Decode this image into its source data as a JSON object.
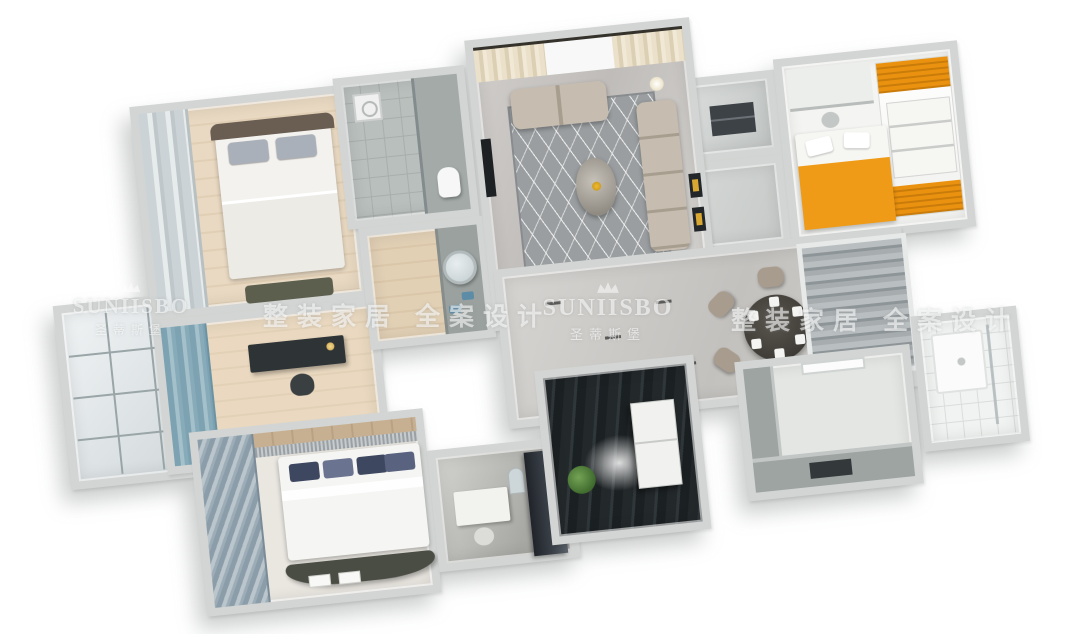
{
  "scene": {
    "type": "3D apartment floor plan render, dollhouse top view",
    "background": "#ffffff"
  },
  "watermark": {
    "brand_latin": "SUNIISBO",
    "brand_chinese": "圣蒂斯堡",
    "slogan": "整装家居 全案设计",
    "color": "rgba(255,255,255,0.58)"
  },
  "palette": {
    "wall_gray": "#d2d5d3",
    "marble_floor": "#c8c6c3",
    "wood_floor": "#e6d6bf",
    "dark_plank_floor": "#23282a",
    "accent_orange": "#ef9b17",
    "accent_blue_curtain": "#7da2b2",
    "sofa_taupe": "#c6bdb0",
    "navy_pillow": "#3e4760",
    "plant_green": "#4e7d3a",
    "white_tile": "#f1f3f2"
  },
  "rooms": [
    {
      "name": "balcony"
    },
    {
      "name": "master-bedroom"
    },
    {
      "name": "study"
    },
    {
      "name": "second-bedroom"
    },
    {
      "name": "home-office"
    },
    {
      "name": "laundry-room"
    },
    {
      "name": "hallway-dining"
    },
    {
      "name": "entry-closet-top"
    },
    {
      "name": "entry-closet-bottom"
    },
    {
      "name": "kids-bedroom"
    },
    {
      "name": "kitchen"
    },
    {
      "name": "bathroom-1"
    },
    {
      "name": "vanity-room"
    },
    {
      "name": "bathroom-2"
    },
    {
      "name": "living-room"
    }
  ]
}
